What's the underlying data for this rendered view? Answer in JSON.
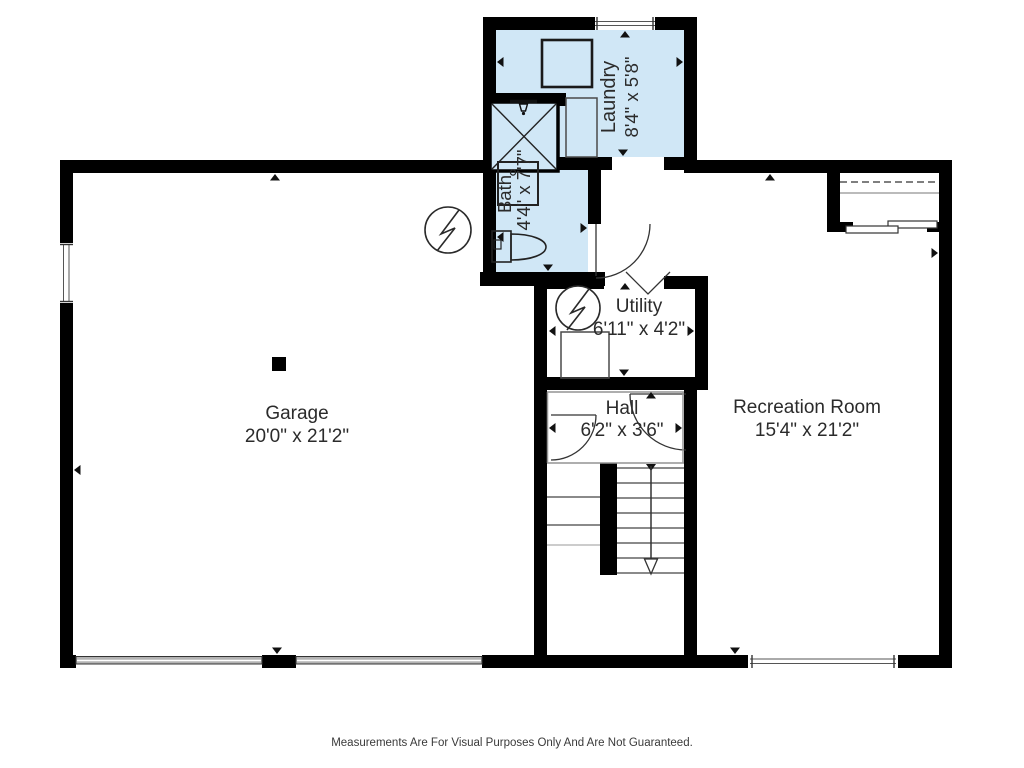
{
  "page": {
    "title": "Basement floor plan",
    "footer_disclaimer": "Measurements Are For Visual Purposes Only And Are Not Guaranteed."
  },
  "colors": {
    "wall": "#000000",
    "highlight_fill": "#d0e7f6",
    "line": "#333333",
    "garage_door_fill": "#b3b3b3"
  },
  "rooms": {
    "laundry": {
      "name": "Laundry",
      "dims": "8'4\" x 5'8\""
    },
    "bath": {
      "name": "Bath",
      "dims": "4'4\" x 7'7\""
    },
    "utility": {
      "name": "Utility",
      "dims": "6'11\" x 4'2\""
    },
    "garage": {
      "name": "Garage",
      "dims": "20'0\" x 21'2\""
    },
    "hall": {
      "name": "Hall",
      "dims": "6'2\" x 3'6\""
    },
    "recreation": {
      "name": "Recreation Room",
      "dims": "15'4\" x 21'2\""
    }
  },
  "symbols": {
    "electrical_1": "circle-bolt-symbol (garage, by bath wall)",
    "electrical_2": "circle-bolt-symbol (utility room)",
    "stairs": "staircase with down arrow"
  }
}
